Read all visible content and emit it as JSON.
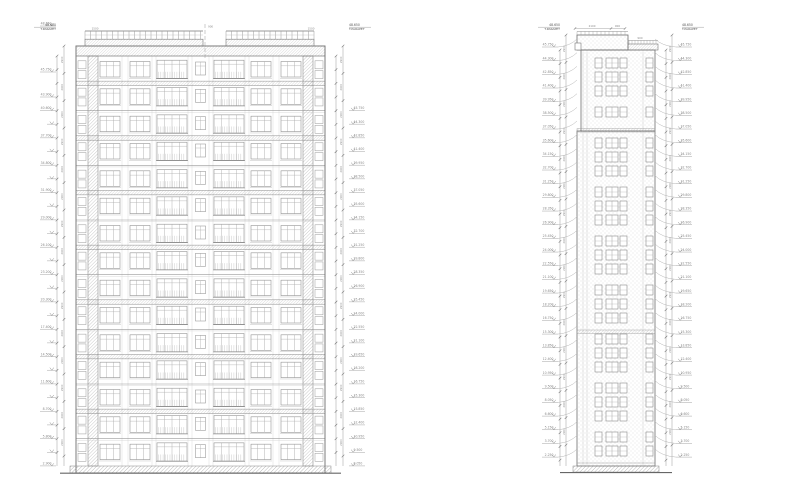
{
  "sheet": {
    "title": "building-elevation-drawing",
    "background": "#ffffff"
  },
  "colors": {
    "outline": "#6f6f6f",
    "line": "#9a9a9a",
    "faint": "#c8c8c8",
    "hatch": "#a8a8a8",
    "stipple": "#b5b5b5",
    "ground": "#666666",
    "text": "#8a8a8a",
    "dark_text": "#555555"
  },
  "texts": {
    "corner": {
      "l1": "48.650",
      "l2": "T.PARAPET"
    },
    "dims": {
      "floor": "2900",
      "sill": "1500",
      "roof_a": "2100",
      "roof_b": "900",
      "small": "900"
    },
    "ground_level": "±0.000"
  },
  "levels": {
    "specials": [
      {
        "y": 26,
        "v": "48.650"
      },
      {
        "y": 72,
        "v": "45.750"
      },
      {
        "y": 97,
        "v": "43.900"
      }
    ],
    "left_start_y": 110.5,
    "right_start_y": 47,
    "step": 13.67,
    "left_rows": 27,
    "right_rows": 31,
    "left_major": [
      "40.600",
      "37.700",
      "34.800",
      "31.900",
      "29.000",
      "26.100",
      "23.200",
      "20.300",
      "17.400",
      "14.500",
      "11.600",
      "8.700",
      "5.800",
      "2.900"
    ],
    "row_values": [
      "45.750",
      "44.300",
      "42.850",
      "41.400",
      "39.950",
      "38.500",
      "37.050",
      "35.600",
      "34.150",
      "32.700",
      "31.250",
      "29.800",
      "28.350",
      "26.900",
      "25.450",
      "24.000",
      "22.550",
      "21.100",
      "19.650",
      "18.200",
      "16.750",
      "15.300",
      "13.850",
      "12.400",
      "10.950",
      "9.500",
      "8.050",
      "6.600",
      "5.150",
      "3.700",
      "2.250"
    ]
  },
  "geometry": {
    "left": {
      "x": 76,
      "w": 249,
      "top": 56,
      "bottom": 466,
      "floors": 15,
      "fh": 27.333,
      "parapet_y": 46,
      "parapet_h": 10,
      "bulkheads": [
        {
          "x": 85,
          "w": 118
        },
        {
          "x": 226,
          "w": 88
        }
      ],
      "rail_y": 31,
      "center_x": 205,
      "chains": [
        {
          "x": 57,
          "minor": true
        },
        {
          "x": 64,
          "minor": false
        },
        {
          "x": 336,
          "minor": true
        },
        {
          "x": 343,
          "minor": false
        }
      ],
      "bays": [
        {
          "x": 0,
          "w": 12,
          "t": "edge"
        },
        {
          "x": 12,
          "w": 10,
          "t": "pier"
        },
        {
          "x": 22,
          "w": 24,
          "t": "win"
        },
        {
          "x": 46,
          "w": 6,
          "t": "wall"
        },
        {
          "x": 52,
          "w": 24,
          "t": "win"
        },
        {
          "x": 76,
          "w": 4,
          "t": "wall"
        },
        {
          "x": 80,
          "w": 32,
          "t": "wide"
        },
        {
          "x": 112,
          "w": 4,
          "t": "wall"
        },
        {
          "x": 116,
          "w": 17,
          "t": "winc"
        },
        {
          "x": 133,
          "w": 4,
          "t": "wall"
        },
        {
          "x": 137,
          "w": 32,
          "t": "wide"
        },
        {
          "x": 169,
          "w": 4,
          "t": "wall"
        },
        {
          "x": 173,
          "w": 24,
          "t": "win"
        },
        {
          "x": 197,
          "w": 6,
          "t": "wall"
        },
        {
          "x": 203,
          "w": 24,
          "t": "win"
        },
        {
          "x": 227,
          "w": 10,
          "t": "pier"
        },
        {
          "x": 237,
          "w": 12,
          "t": "edge"
        }
      ]
    },
    "right": {
      "upper": {
        "x": 581,
        "w": 74,
        "y1": 50,
        "y2": 131
      },
      "lower": {
        "x": 577,
        "w": 78,
        "y1": 131,
        "y2": 466
      },
      "bulkhead": {
        "x": 577,
        "w": 51,
        "y": 35,
        "h": 15
      },
      "parapet": {
        "x": 628,
        "w": 30,
        "y": 44,
        "h": 6
      },
      "step": {
        "x": 575,
        "w": 6,
        "y": 43,
        "h": 7
      },
      "bands": [
        128.5,
        330
      ],
      "cols": [
        {
          "x": 595,
          "w": 7
        },
        {
          "x": 606,
          "w": 12,
          "d": 1
        },
        {
          "x": 620,
          "w": 7
        },
        {
          "x": 646,
          "w": 7
        }
      ],
      "zones": [
        {
          "y1": 58,
          "y2": 126
        },
        {
          "y1": 138,
          "y2": 458
        }
      ],
      "verticals": [
        583,
        587,
        643
      ],
      "chains": [
        {
          "x": 560,
          "minor": true
        },
        {
          "x": 566,
          "minor": false
        },
        {
          "x": 666,
          "minor": true
        },
        {
          "x": 672,
          "minor": false
        }
      ]
    }
  }
}
